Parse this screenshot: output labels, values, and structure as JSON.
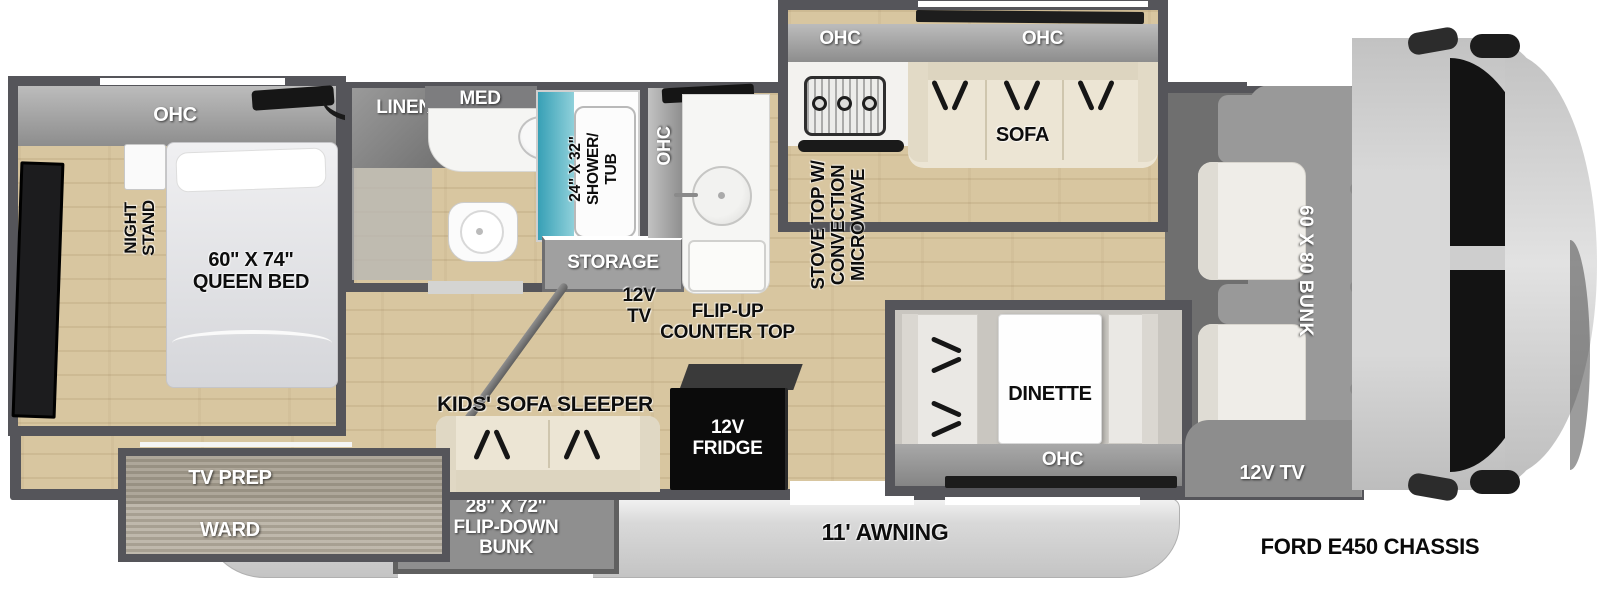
{
  "floorplan": {
    "chassis": "FORD E450 CHASSIS",
    "awning": "11' AWNING",
    "bedroom": {
      "ohc": "OHC",
      "night_stand": "NIGHT\nSTAND",
      "queen_bed": "60\" X 74\"\nQUEEN BED",
      "tv_prep": "TV PREP",
      "ward": "WARD"
    },
    "bathroom": {
      "linen": "LINEN",
      "med": "MED",
      "shower_tub": "24\" X 32\"\nSHOWER/\nTUB"
    },
    "hallway": {
      "storage": "STORAGE",
      "tv_12v": "12V\nTV",
      "ohc": "OHC"
    },
    "kitchen": {
      "ohc_left": "OHC",
      "ohc_right": "OHC",
      "stove": "STOVE TOP W/\nCONVECTION\nMICROWAVE",
      "sofa": "SOFA",
      "flip_up_counter": "FLIP-UP\nCOUNTER TOP",
      "fridge": "12V\nFRIDGE"
    },
    "bunk_area": {
      "kids_sofa_sleeper": "KIDS' SOFA SLEEPER",
      "flip_down_bunk": "28\" X 72\"\nFLIP-DOWN\nBUNK"
    },
    "dinette": {
      "label": "DINETTE",
      "ohc": "OHC"
    },
    "cab": {
      "bunk": "60 X 80 BUNK",
      "tv": "12V TV"
    },
    "colors": {
      "wall": "#55555a",
      "floor_wood": "#d8c6a0",
      "shower_teal": "#49aabd",
      "cabinet_gray": "#9a9a9a"
    }
  }
}
